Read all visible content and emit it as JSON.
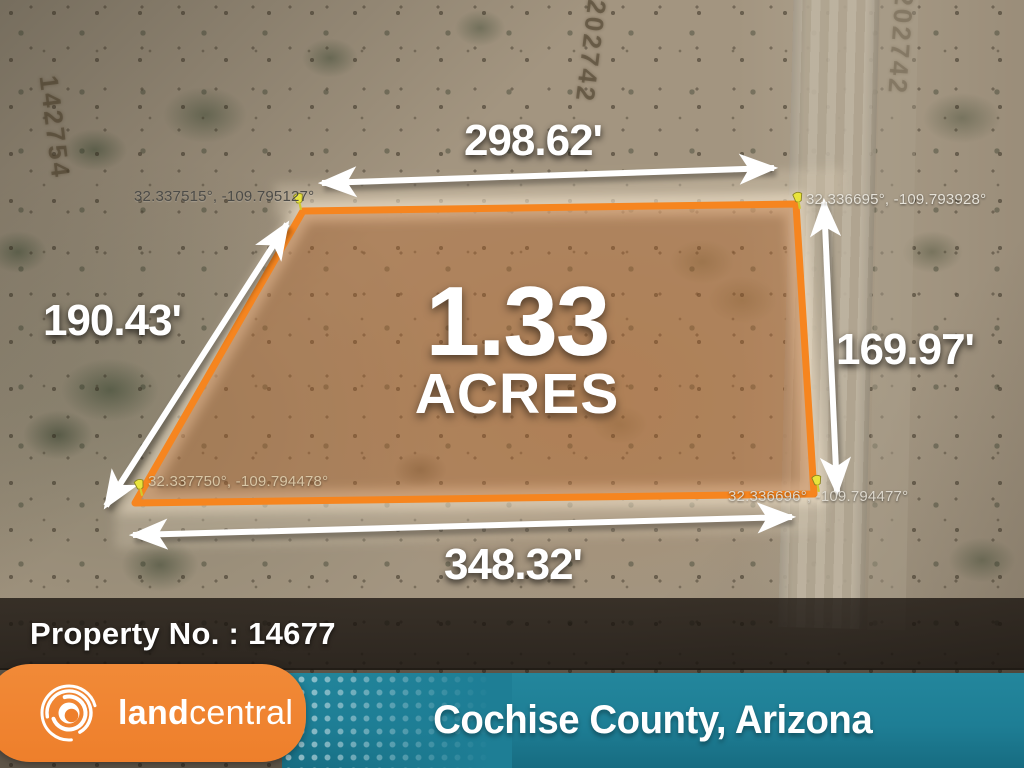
{
  "map": {
    "acreage_value": "1.33",
    "acreage_unit": "ACRES",
    "dimensions": {
      "top": "298.62'",
      "left": "190.43'",
      "right": "169.97'",
      "bottom": "348.32'"
    },
    "corner_coordinates": {
      "top_left": "32.337515°, -109.795127°",
      "top_right": "32.336695°, -109.793928°",
      "bottom_left": "32.337750°, -109.794478°",
      "bottom_right": "32.336696°, -109.794477°"
    },
    "ground_labels": [
      "202742",
      "142754"
    ],
    "parcel_outline_color": "#f6851f",
    "pin_color": "#e9e43c"
  },
  "property_bar": {
    "label": "Property No. : 14677"
  },
  "footer": {
    "brand_land": "land",
    "brand_central": "central",
    "location": "Cochise County, Arizona",
    "brand_bg_color": "#ef8330",
    "location_bar_color": "#1e7e95"
  }
}
